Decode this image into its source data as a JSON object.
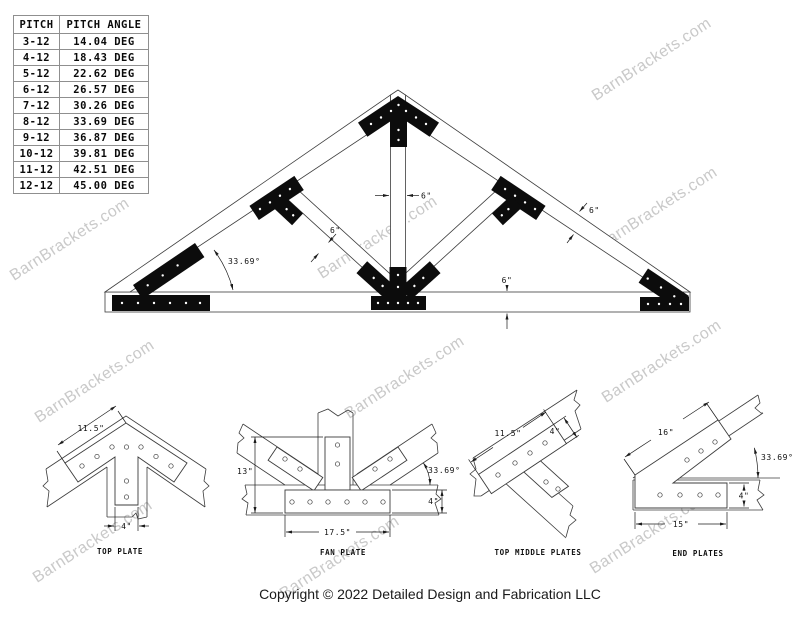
{
  "watermark": {
    "text": "BarnBrackets.com"
  },
  "footer": {
    "copyright": "Copyright © 2022 Detailed Design and Fabrication LLC"
  },
  "pitch_table": {
    "headers": [
      "PITCH",
      "PITCH ANGLE"
    ],
    "rows": [
      [
        "3-12",
        "14.04 DEG"
      ],
      [
        "4-12",
        "18.43 DEG"
      ],
      [
        "5-12",
        "22.62 DEG"
      ],
      [
        "6-12",
        "26.57 DEG"
      ],
      [
        "7-12",
        "30.26 DEG"
      ],
      [
        "8-12",
        "33.69 DEG"
      ],
      [
        "9-12",
        "36.87 DEG"
      ],
      [
        "10-12",
        "39.81 DEG"
      ],
      [
        "11-12",
        "42.51 DEG"
      ],
      [
        "12-12",
        "45.00 DEG"
      ]
    ]
  },
  "truss": {
    "dims": {
      "pitch_angle": "33.69°",
      "king_post_width": "6\"",
      "strut_width": "6\"",
      "rafter_width": "6\"",
      "chord_depth": "6\""
    }
  },
  "details": {
    "top_plate": {
      "caption": "TOP PLATE",
      "dim_length": "11.5\"",
      "dim_width": "4\""
    },
    "fan_plate": {
      "caption": "FAN PLATE",
      "dim_height": "13\"",
      "dim_angle": "33.69°",
      "dim_width": "4\"",
      "dim_length": "17.5\""
    },
    "top_middle": {
      "caption": "TOP MIDDLE PLATES",
      "dim_length": "11.5\"",
      "dim_width": "4\""
    },
    "end_plates": {
      "caption": "END PLATES",
      "dim_length": "16\"",
      "dim_angle": "33.69°",
      "dim_width": "4\"",
      "dim_bottom": "15\""
    }
  }
}
